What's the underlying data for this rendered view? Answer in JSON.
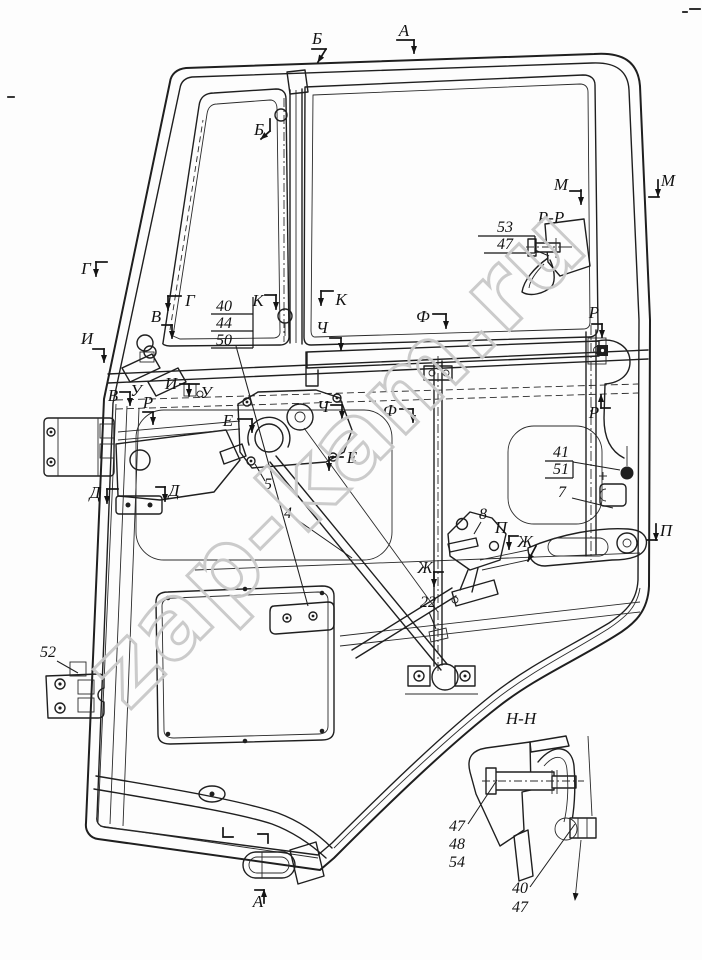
{
  "watermark": "zap-kam.ru",
  "colors": {
    "ink": "#1f1f1f",
    "watermark": "#c9c9c9",
    "paper": "#fdfdfd"
  },
  "labels": {
    "b_top": "Б",
    "a_top": "А",
    "b_vent": "Б",
    "m_left": "М",
    "m_right": "М",
    "pp": "Р-Р",
    "n53": "53",
    "n47a": "47",
    "g_left": "Г",
    "g_frame": "Г",
    "n40": "40",
    "n44": "44",
    "n50": "50",
    "k_left": "К",
    "k_right": "К",
    "v_upper": "В",
    "i_left": "И",
    "ch_upper": "Ч",
    "f_upper": "Ф",
    "r_top": "Р",
    "v_lower": "В",
    "u_left": "У",
    "i_mid": "И",
    "u_mid": "У",
    "r_left": "Р",
    "e_left": "Е",
    "ch_mid": "Ч",
    "f_mid": "Ф",
    "e_right": "Е",
    "r_mid": "Р",
    "d_left": "Д",
    "d_right": "Д",
    "n5": "5",
    "n4": "4",
    "n41": "41",
    "n51": "51",
    "n7": "7",
    "n8": "8",
    "p_lock": "П",
    "zh_lock": "Ж",
    "p_right": "П",
    "zh_left": "Ж",
    "n22": "22",
    "n52": "52",
    "nn": "Н-Н",
    "n47b": "47",
    "n48": "48",
    "n54": "54",
    "n40b": "40",
    "n47c": "47",
    "a_bottom": "А"
  }
}
